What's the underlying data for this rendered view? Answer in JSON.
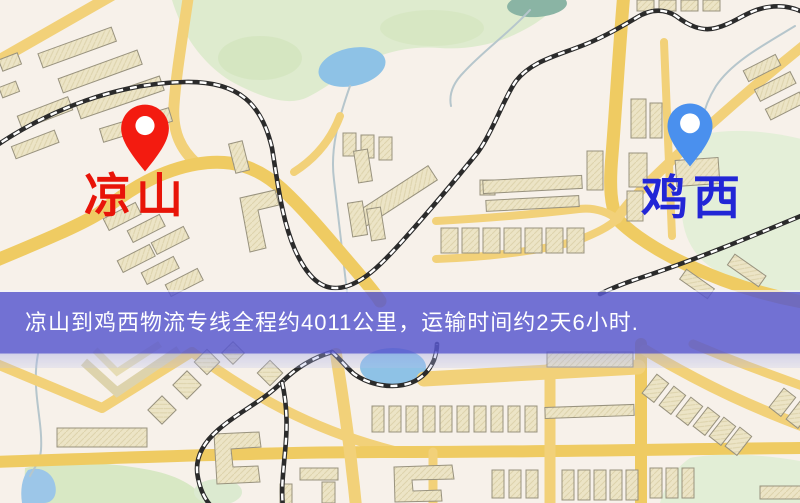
{
  "banner": {
    "text": "凉山到鸡西物流专线全程约4011公里，运输时间约2天6小时.",
    "background_color": "#5858ce",
    "text_color": "#ffffff"
  },
  "markers": {
    "origin": {
      "label": "凉山",
      "pin_color": "#f31b10",
      "label_color": "#e81408"
    },
    "destination": {
      "label": "鸡西",
      "pin_color": "#4a90ee",
      "label_color": "#2226d6"
    }
  },
  "route": {
    "origin": "凉山",
    "destination": "鸡西",
    "service_type": "物流专线",
    "distance": "约4011公里",
    "duration": "约2天6小时"
  },
  "map_colors": {
    "base": "#f7f1ea",
    "road": "#f2d179",
    "building": "#ece4c6",
    "park": "#deebce",
    "water": "#8ec2e6",
    "railway": "#2b2b2b"
  }
}
